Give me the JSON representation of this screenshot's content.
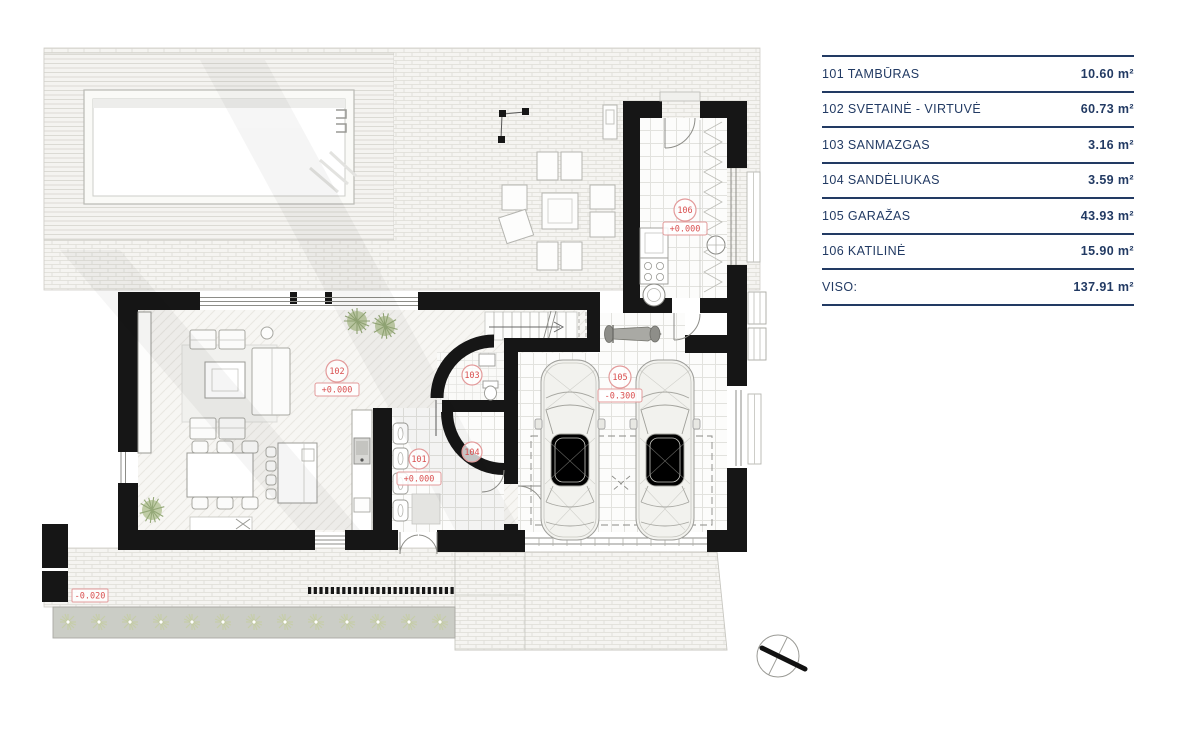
{
  "legend": {
    "rows": [
      {
        "label": "101 TAMBŪRAS",
        "area": "10.60 m²"
      },
      {
        "label": "102 SVETAINĖ - VIRTUVĖ",
        "area": "60.73 m²"
      },
      {
        "label": "103 SANMAZGAS",
        "area": "3.16 m²"
      },
      {
        "label": "104 SANDĖLIUKAS",
        "area": "3.59 m²"
      },
      {
        "label": "105 GARAŽAS",
        "area": "43.93 m²"
      },
      {
        "label": "106 KATILINĖ",
        "area": "15.90 m²"
      },
      {
        "label": "VISO:",
        "area": "137.91 m²"
      }
    ],
    "text_color": "#223a63"
  },
  "plan": {
    "rooms": [
      {
        "number": "101",
        "elevation": "+0.000"
      },
      {
        "number": "102",
        "elevation": "+0.000"
      },
      {
        "number": "103",
        "elevation": ""
      },
      {
        "number": "104",
        "elevation": ""
      },
      {
        "number": "105",
        "elevation": "-0.300"
      },
      {
        "number": "106",
        "elevation": "+0.000"
      }
    ],
    "site": {
      "ground_elevation": "-0.020"
    },
    "label_color": "#d94f4f"
  }
}
